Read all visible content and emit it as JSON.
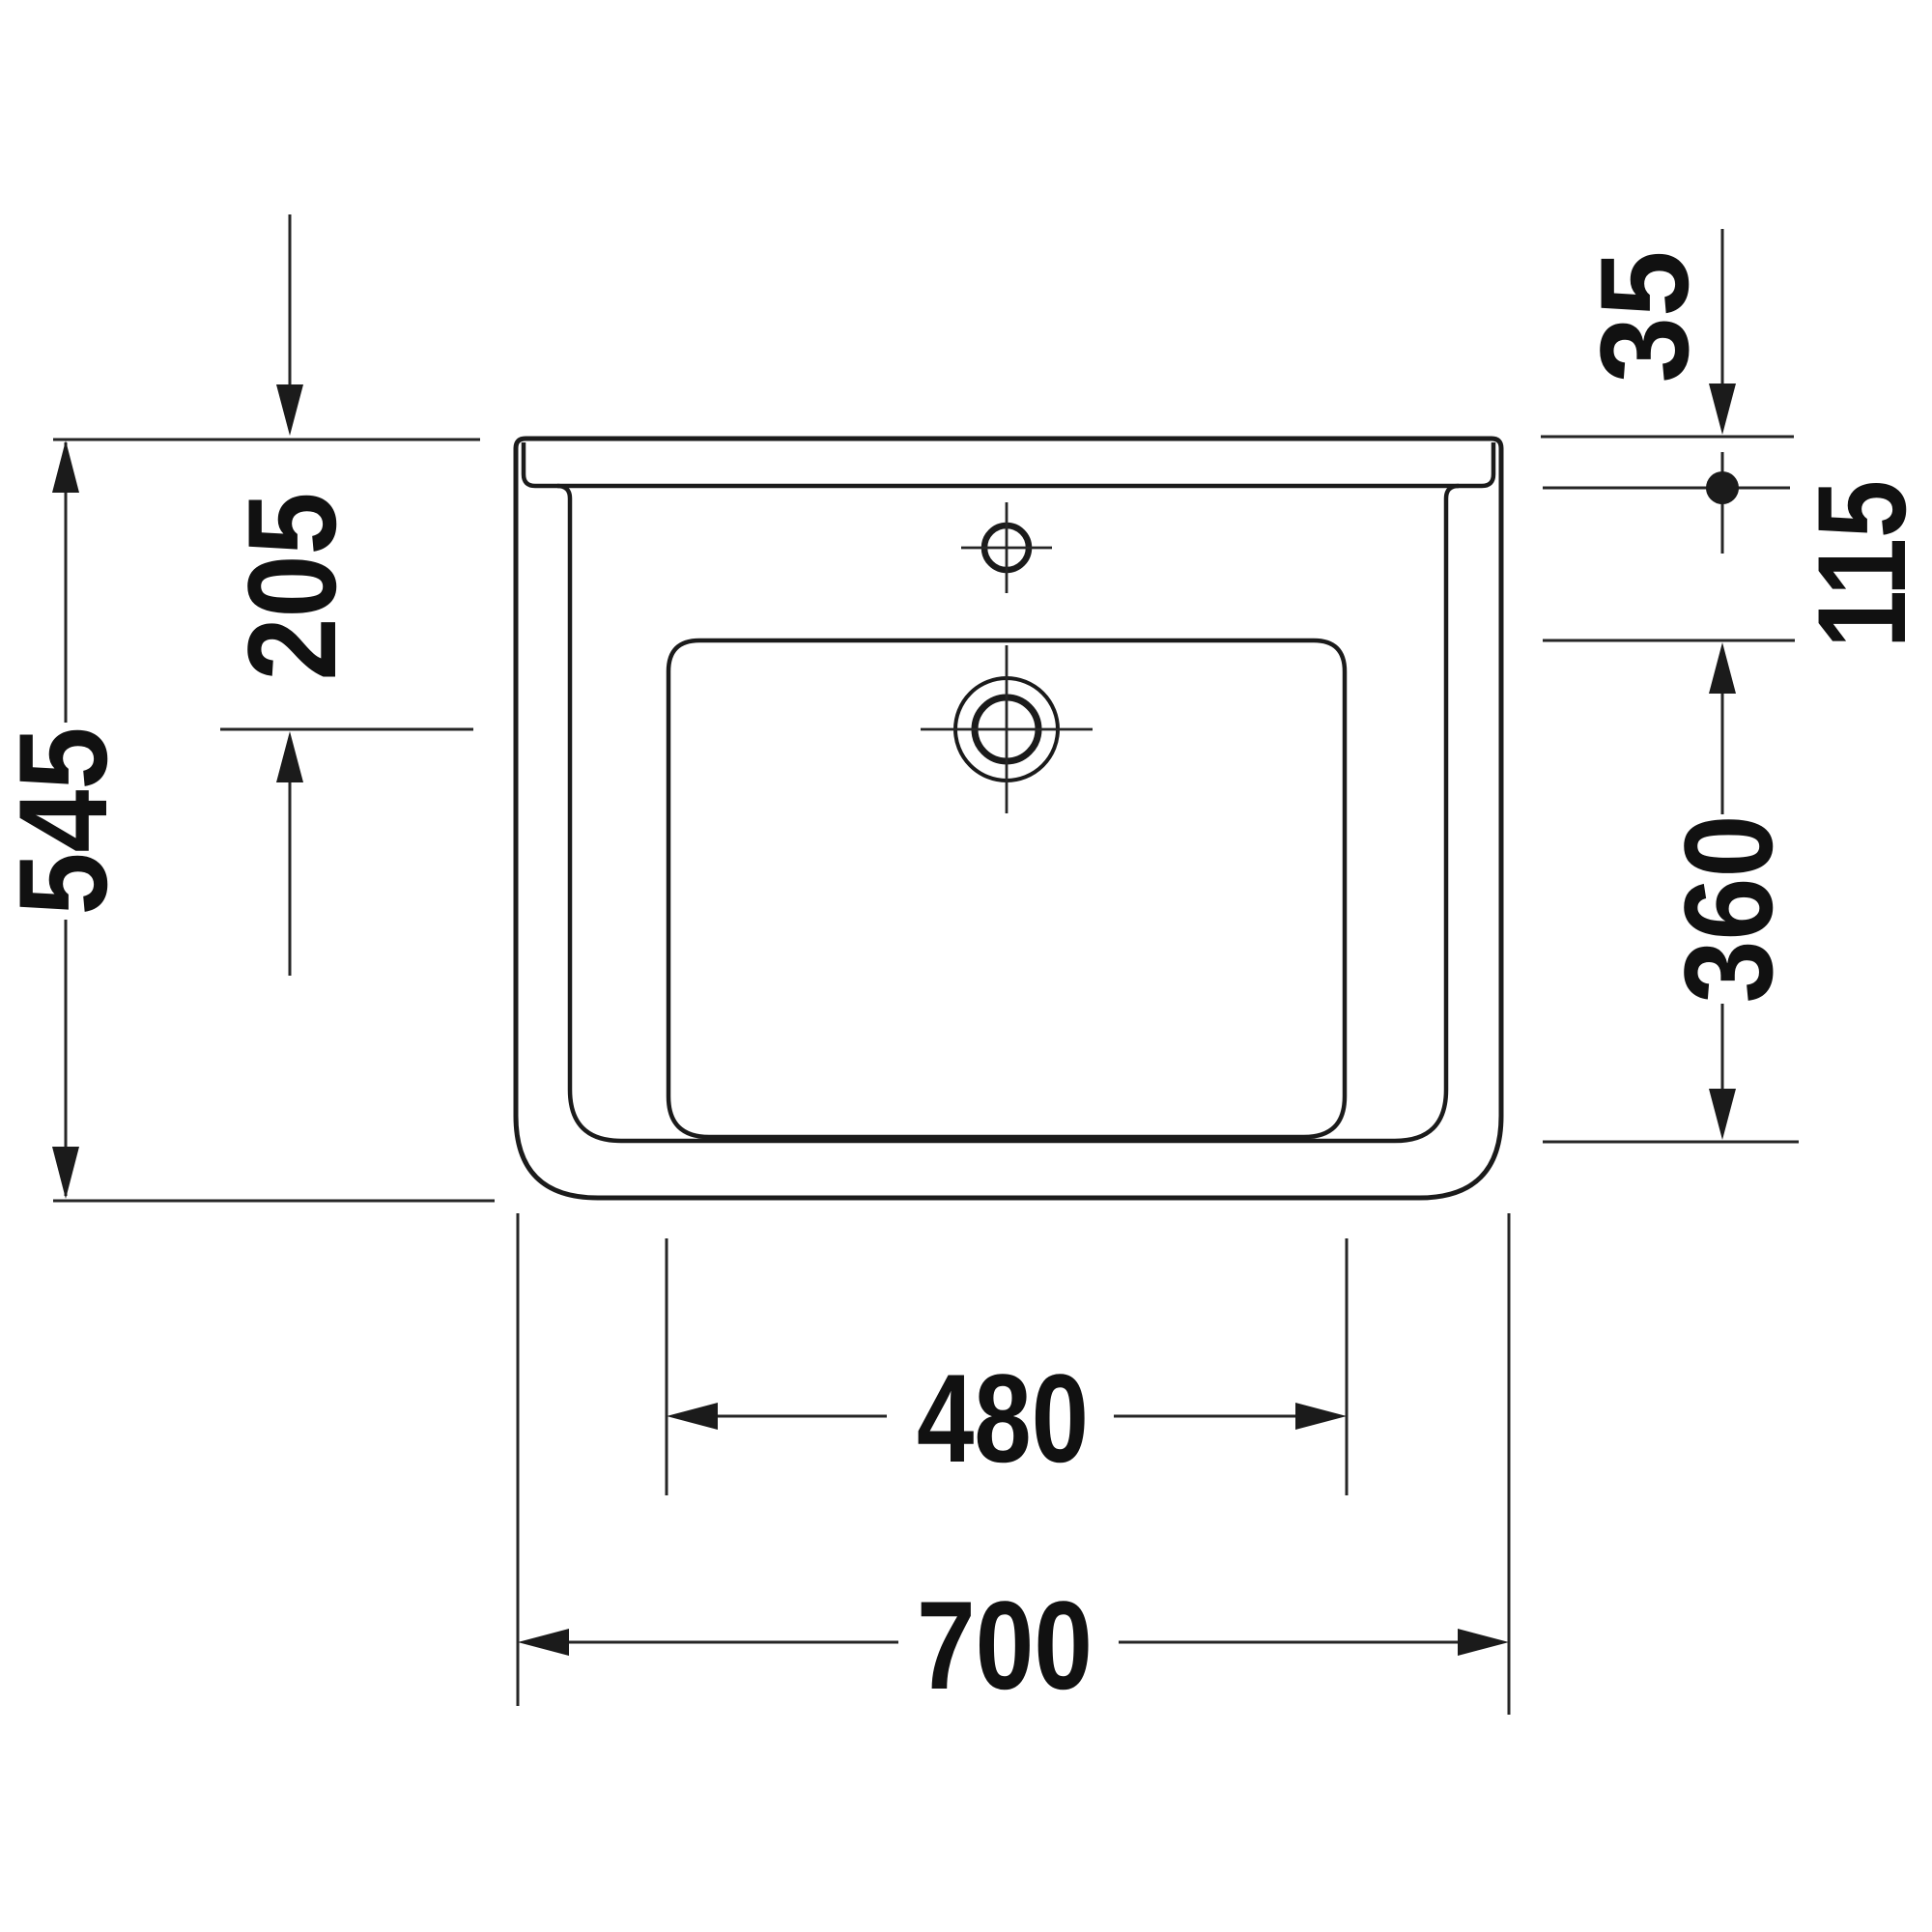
{
  "drawing": {
    "title": "washbasin-technical-drawing-top-view",
    "background_color": "#ffffff",
    "line_color": "#1b1b1b",
    "text_color": "#111111",
    "dimensions": {
      "left_outer": "545",
      "left_inner": "205",
      "right_top": "35",
      "right_upper": "115",
      "right_lower": "360",
      "bottom_inner": "480",
      "bottom_outer": "700"
    }
  }
}
